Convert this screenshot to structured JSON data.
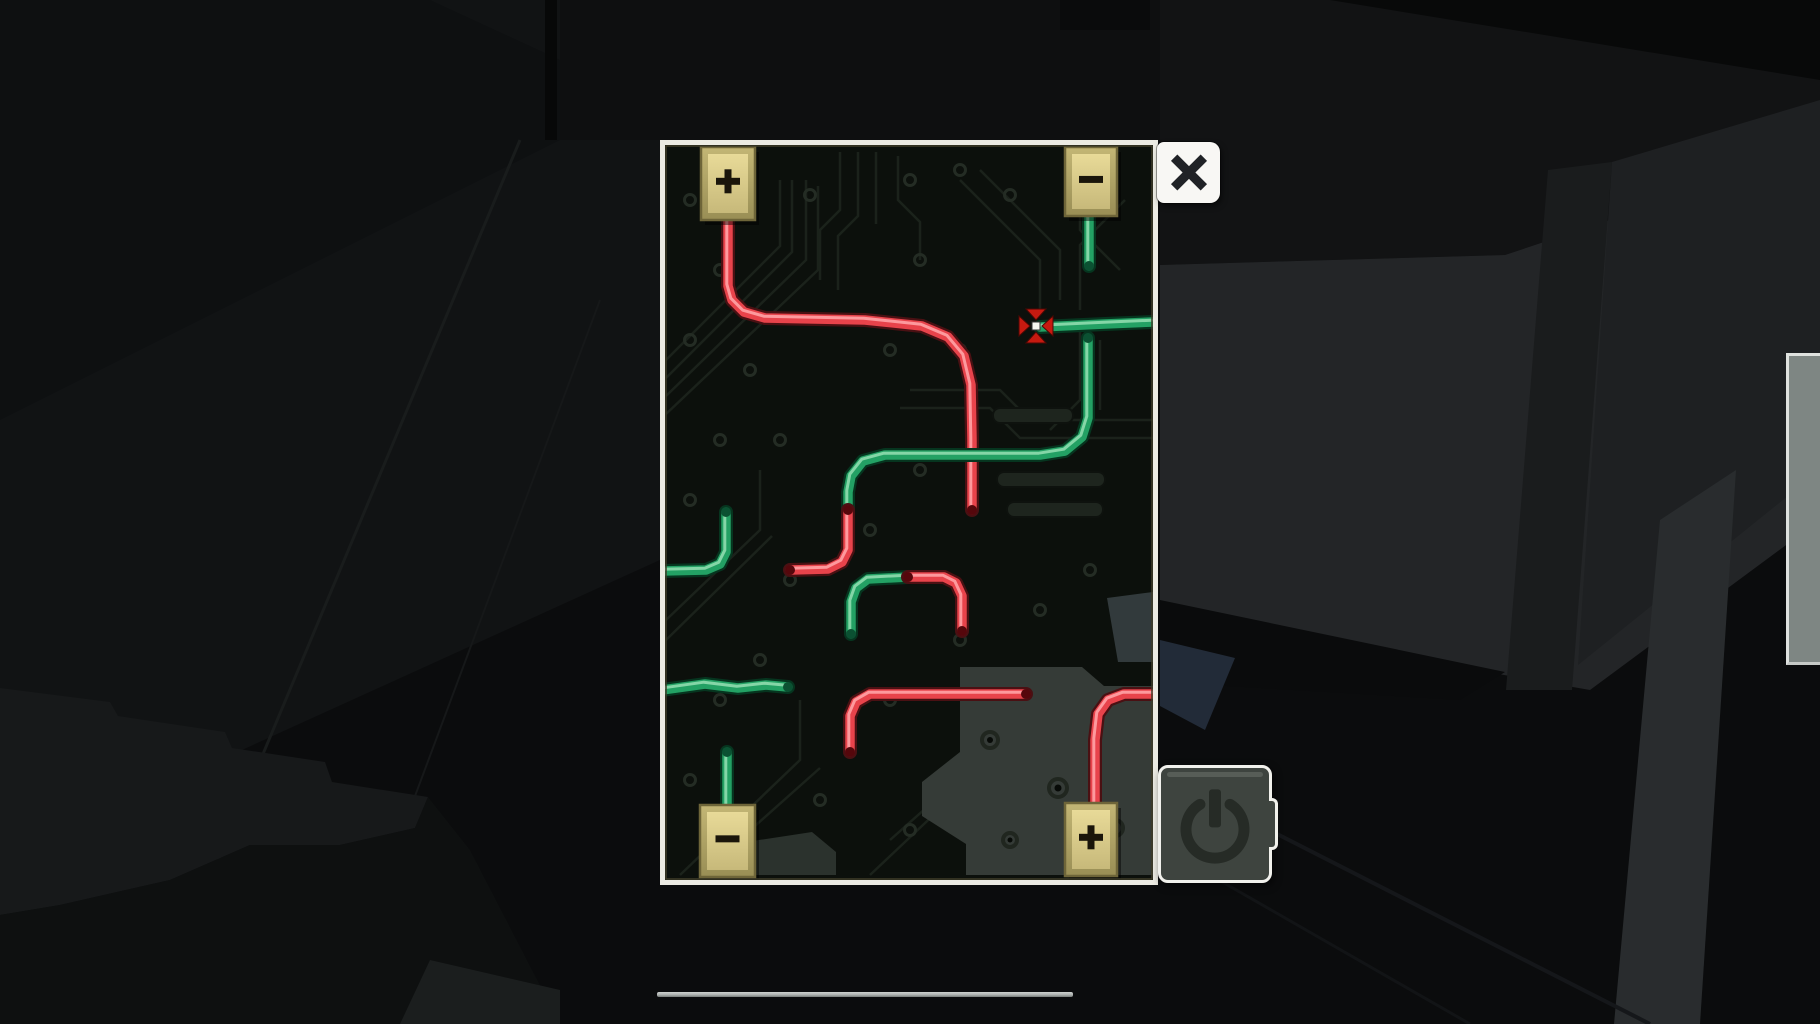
{
  "screen": {
    "width": 1820,
    "height": 1024
  },
  "puzzle": {
    "panel": {
      "x": 660,
      "y": 140,
      "width": 498,
      "height": 745
    },
    "terminals": [
      {
        "id": "top-left",
        "sign": "+",
        "rect": [
          41,
          7,
          54,
          73
        ]
      },
      {
        "id": "top-right",
        "sign": "-",
        "rect": [
          405,
          7,
          52,
          69
        ]
      },
      {
        "id": "bottom-left",
        "sign": "-",
        "rect": [
          40,
          665,
          55,
          72
        ]
      },
      {
        "id": "bottom-right",
        "sign": "+",
        "rect": [
          405,
          663,
          52,
          73
        ]
      }
    ],
    "wires": [
      {
        "id": "w1-red-from-plus-topleft",
        "segments": [
          {
            "color": "red",
            "points": [
              [
                68,
                80
              ],
              [
                68,
                146
              ],
              [
                72,
                160
              ],
              [
                84,
                172
              ],
              [
                105,
                178
              ],
              [
                205,
                180
              ],
              [
                262,
                186
              ],
              [
                288,
                197
              ],
              [
                304,
                216
              ],
              [
                311,
                245
              ],
              [
                312,
                300
              ],
              [
                312,
                370
              ]
            ],
            "cap_end": true
          }
        ]
      },
      {
        "id": "w2-green-stub-topright",
        "segments": [
          {
            "color": "green",
            "points": [
              [
                429,
                76
              ],
              [
                429,
                126
              ]
            ],
            "cap_end": true
          }
        ]
      },
      {
        "id": "w3-green-cursor-wire",
        "segments": [
          {
            "color": "green",
            "points": [
              [
                380,
                187
              ],
              [
                445,
                184
              ],
              [
                493,
                182
              ]
            ]
          }
        ]
      },
      {
        "id": "w4-green-red-s-wire",
        "segments": [
          {
            "color": "green",
            "points": [
              [
                428,
                198
              ],
              [
                428,
                278
              ],
              [
                422,
                297
              ],
              [
                405,
                311
              ],
              [
                380,
                315
              ],
              [
                225,
                315
              ],
              [
                203,
                321
              ],
              [
                191,
                336
              ],
              [
                188,
                352
              ],
              [
                188,
                370
              ]
            ],
            "cap_start": true,
            "cap_end": true
          },
          {
            "color": "red",
            "points": [
              [
                188,
                370
              ],
              [
                188,
                410
              ],
              [
                182,
                422
              ],
              [
                168,
                429
              ],
              [
                130,
                430
              ]
            ],
            "cap_start": true,
            "cap_end": true
          }
        ]
      },
      {
        "id": "w5-green-red-elbow",
        "segments": [
          {
            "color": "green",
            "points": [
              [
                191,
                494
              ],
              [
                191,
                462
              ],
              [
                196,
                448
              ],
              [
                208,
                439
              ],
              [
                248,
                437
              ]
            ],
            "cap_start": true,
            "cap_end": true
          },
          {
            "color": "red",
            "points": [
              [
                248,
                437
              ],
              [
                284,
                437
              ],
              [
                296,
                443
              ],
              [
                302,
                456
              ],
              [
                302,
                491
              ]
            ],
            "cap_start": true,
            "cap_end": true
          }
        ]
      },
      {
        "id": "w6-green-left-elbow",
        "segments": [
          {
            "color": "green",
            "points": [
              [
                66,
                372
              ],
              [
                66,
                412
              ],
              [
                60,
                424
              ],
              [
                46,
                430
              ],
              [
                2,
                431
              ]
            ],
            "cap_start": true
          }
        ]
      },
      {
        "id": "w7-green-horizontal-left",
        "segments": [
          {
            "color": "green",
            "points": [
              [
                2,
                550
              ],
              [
                45,
                544
              ],
              [
                78,
                548
              ],
              [
                106,
                545
              ],
              [
                128,
                547
              ]
            ],
            "cap_end": true
          }
        ]
      },
      {
        "id": "w8-green-stub-bottomleft",
        "segments": [
          {
            "color": "green",
            "points": [
              [
                67,
                612
              ],
              [
                67,
                666
              ]
            ],
            "cap_start": true
          }
        ]
      },
      {
        "id": "w9-red-horizontal-bottom",
        "segments": [
          {
            "color": "red",
            "points": [
              [
                190,
                612
              ],
              [
                190,
                576
              ],
              [
                196,
                562
              ],
              [
                210,
                554
              ],
              [
                366,
                554
              ]
            ],
            "cap_start": true,
            "cap_end": true
          }
        ]
      },
      {
        "id": "w10-red-to-plus-bottomright",
        "segments": [
          {
            "color": "red",
            "points": [
              [
                493,
                554
              ],
              [
                464,
                554
              ],
              [
                448,
                560
              ],
              [
                438,
                574
              ],
              [
                435,
                600
              ],
              [
                435,
                664
              ]
            ]
          }
        ]
      }
    ],
    "cursor_marker": {
      "x": 376,
      "y": 186
    }
  },
  "controls": {
    "close_button": {
      "icon": "close-x"
    },
    "power_button": {
      "icon": "power"
    }
  },
  "hud": {
    "bottom_scroll_line": {
      "x": 657,
      "y": 992,
      "width": 416,
      "height": 5
    },
    "right_edge_tab": {
      "x": 1786,
      "y": 353,
      "width": 34,
      "height": 306
    }
  },
  "colors": {
    "wire_red": "#e8434b",
    "wire_red_highlight": "#ffa3a6",
    "wire_red_outline": "#4a1013",
    "wire_red_cap": "#55070c",
    "wire_green": "#23a164",
    "wire_green_highlight": "#8fdcae",
    "wire_green_outline": "#06351f",
    "wire_green_cap": "#0b5132",
    "terminal_fill": "#e0d292",
    "terminal_frame": "#b0a467",
    "terminal_border": "#6e6539",
    "terminal_glyph": "#1a150a",
    "panel_frame": "#ecebe3",
    "board_bg": "#0c100c",
    "marker_red": "#c61a10",
    "marker_center": "#f5f5f0"
  }
}
